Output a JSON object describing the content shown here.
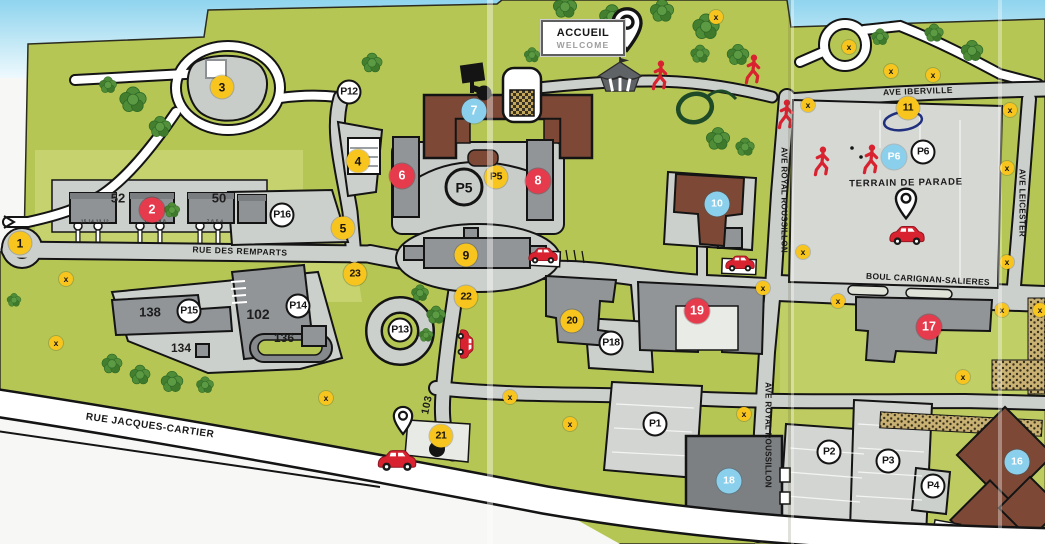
{
  "map_title": "Campus site map (scanned)",
  "sign": {
    "line1": "ACCUEIL",
    "line2": "WELCOME"
  },
  "colors": {
    "grass": "#b6c654",
    "grass_light": "#c8d472",
    "road": "#ccd0cc",
    "parade_ground": "#d6d8d4",
    "building_gray": "#919598",
    "building_brown": "#7d4936",
    "marker_yellow": "#f7c51e",
    "marker_red": "#e63b4d",
    "marker_blue": "#8ad0ec",
    "icon_red": "#d8222f",
    "sky": "#8fd4ee"
  },
  "streets": [
    {
      "id": "rue-des-remparts",
      "text": "RUE DES REMPARTS",
      "x": 240,
      "y": 251,
      "rot": 2,
      "size": 8.5,
      "sp": 0.5
    },
    {
      "id": "rue-jacques-cartier",
      "text": "RUE JACQUES-CARTIER",
      "x": 150,
      "y": 426,
      "rot": 8,
      "size": 10,
      "sp": 0.5
    },
    {
      "id": "boul-carignan-salieres",
      "text": "BOUL CARIGNAN-SALIERES",
      "x": 928,
      "y": 279,
      "rot": 3,
      "size": 8.5,
      "sp": 0.3
    },
    {
      "id": "ave-royal-roussillon-north",
      "text": "AVE ROYAL ROUSSILLON",
      "x": 784,
      "y": 200,
      "rot": 90,
      "size": 8,
      "sp": 0.3
    },
    {
      "id": "ave-royal-roussillon-south",
      "text": "AVE ROYAL ROUSSILLON",
      "x": 768,
      "y": 435,
      "rot": 90,
      "size": 8,
      "sp": 0.3
    },
    {
      "id": "ave-iberville",
      "text": "AVE IBERVILLE",
      "x": 918,
      "y": 91,
      "rot": -2,
      "size": 8.5,
      "sp": 0.5
    },
    {
      "id": "ave-leicester",
      "text": "AVE LEICESTER",
      "x": 1022,
      "y": 203,
      "rot": 90,
      "size": 8,
      "sp": 0.4
    },
    {
      "id": "terrain-de-parade",
      "text": "TERRAIN DE PARADE",
      "x": 906,
      "y": 183,
      "rot": -1,
      "size": 9.5,
      "sp": 0.8
    },
    {
      "id": "route-103",
      "text": "103",
      "x": 427,
      "y": 405,
      "rot": -78,
      "size": 10.5,
      "sp": 0.5
    }
  ],
  "building_labels": [
    {
      "text": "52",
      "x": 118,
      "y": 198,
      "size": 13
    },
    {
      "text": "50",
      "x": 219,
      "y": 198,
      "size": 13
    },
    {
      "text": "138",
      "x": 150,
      "y": 312,
      "size": 13
    },
    {
      "text": "102",
      "x": 258,
      "y": 314,
      "size": 14
    },
    {
      "text": "134",
      "x": 181,
      "y": 348,
      "size": 12
    },
    {
      "text": "136",
      "x": 284,
      "y": 338,
      "size": 12
    }
  ],
  "lot_numbers": [
    {
      "text": "15 14 13 12",
      "x": 95,
      "y": 221
    },
    {
      "text": "11 10 9 8",
      "x": 155,
      "y": 221
    },
    {
      "text": "7 6 5 4",
      "x": 215,
      "y": 221
    }
  ],
  "markers": [
    {
      "type": "yellow",
      "label": "1",
      "x": 20,
      "y": 243
    },
    {
      "type": "yellow",
      "label": "3",
      "x": 222,
      "y": 87
    },
    {
      "type": "yellow",
      "label": "4",
      "x": 358,
      "y": 161
    },
    {
      "type": "yellow",
      "label": "5",
      "x": 343,
      "y": 228
    },
    {
      "type": "yellow",
      "label": "9",
      "x": 466,
      "y": 255
    },
    {
      "type": "yellow",
      "label": "11",
      "x": 908,
      "y": 108
    },
    {
      "type": "yellow",
      "label": "20",
      "x": 572,
      "y": 321
    },
    {
      "type": "yellow",
      "label": "21",
      "x": 441,
      "y": 436
    },
    {
      "type": "yellow",
      "label": "22",
      "x": 466,
      "y": 297
    },
    {
      "type": "yellow",
      "label": "23",
      "x": 355,
      "y": 274
    },
    {
      "type": "yellow",
      "label": "P5",
      "x": 496,
      "y": 177
    },
    {
      "type": "red",
      "label": "2",
      "x": 152,
      "y": 210
    },
    {
      "type": "red",
      "label": "6",
      "x": 402,
      "y": 176
    },
    {
      "type": "red",
      "label": "8",
      "x": 538,
      "y": 181
    },
    {
      "type": "red",
      "label": "17",
      "x": 929,
      "y": 327
    },
    {
      "type": "red",
      "label": "19",
      "x": 697,
      "y": 311
    },
    {
      "type": "blue",
      "label": "7",
      "x": 474,
      "y": 111
    },
    {
      "type": "blue",
      "label": "10",
      "x": 717,
      "y": 204
    },
    {
      "type": "blue",
      "label": "16",
      "x": 1017,
      "y": 462
    },
    {
      "type": "blue",
      "label": "18",
      "x": 729,
      "y": 481
    },
    {
      "type": "blue",
      "label": "P6",
      "x": 894,
      "y": 157
    },
    {
      "type": "parking",
      "label": "P12",
      "x": 349,
      "y": 92
    },
    {
      "type": "parking",
      "label": "P16",
      "x": 282,
      "y": 215
    },
    {
      "type": "parking",
      "label": "P15",
      "x": 189,
      "y": 311
    },
    {
      "type": "parking",
      "label": "P14",
      "x": 298,
      "y": 306
    },
    {
      "type": "parking",
      "label": "P13",
      "x": 400,
      "y": 330
    },
    {
      "type": "parking",
      "label": "P18",
      "x": 611,
      "y": 343
    },
    {
      "type": "parking",
      "label": "P1",
      "x": 655,
      "y": 424
    },
    {
      "type": "parking",
      "label": "P2",
      "x": 829,
      "y": 452
    },
    {
      "type": "parking",
      "label": "P3",
      "x": 888,
      "y": 461
    },
    {
      "type": "parking",
      "label": "P4",
      "x": 933,
      "y": 486
    },
    {
      "type": "parking",
      "label": "P6",
      "x": 923,
      "y": 152
    },
    {
      "type": "ring",
      "label": "P5",
      "x": 464,
      "y": 187
    }
  ],
  "x_marks": [
    {
      "x": 716,
      "y": 17
    },
    {
      "x": 849,
      "y": 47
    },
    {
      "x": 891,
      "y": 71
    },
    {
      "x": 933,
      "y": 75
    },
    {
      "x": 808,
      "y": 105
    },
    {
      "x": 1010,
      "y": 110
    },
    {
      "x": 1007,
      "y": 168
    },
    {
      "x": 803,
      "y": 252
    },
    {
      "x": 1007,
      "y": 262
    },
    {
      "x": 763,
      "y": 288
    },
    {
      "x": 838,
      "y": 301
    },
    {
      "x": 1002,
      "y": 310
    },
    {
      "x": 1040,
      "y": 310
    },
    {
      "x": 963,
      "y": 377
    },
    {
      "x": 66,
      "y": 279
    },
    {
      "x": 56,
      "y": 343
    },
    {
      "x": 326,
      "y": 398
    },
    {
      "x": 510,
      "y": 397
    },
    {
      "x": 570,
      "y": 424
    },
    {
      "x": 744,
      "y": 414
    }
  ],
  "icons": {
    "x_glyph": "x",
    "cars": [
      {
        "x": 543,
        "y": 258,
        "rot": 0,
        "w": 34
      },
      {
        "x": 740,
        "y": 266,
        "rot": 0,
        "w": 34
      },
      {
        "x": 907,
        "y": 238,
        "rot": 0,
        "w": 40
      },
      {
        "x": 397,
        "y": 463,
        "rot": 0,
        "w": 44
      },
      {
        "x": 463,
        "y": 344,
        "rot": 90,
        "w": 34
      }
    ],
    "persons": [
      {
        "x": 660,
        "y": 78
      },
      {
        "x": 753,
        "y": 72
      },
      {
        "x": 786,
        "y": 117
      },
      {
        "x": 822,
        "y": 164
      },
      {
        "x": 871,
        "y": 162
      }
    ],
    "pins": [
      {
        "x": 627,
        "y": 32,
        "h": 46
      },
      {
        "x": 906,
        "y": 206,
        "h": 33
      },
      {
        "x": 403,
        "y": 423,
        "h": 30
      }
    ],
    "tent": {
      "x": 620,
      "y": 77,
      "w": 50
    },
    "trees": [
      {
        "x": 133,
        "y": 103,
        "s": 34
      },
      {
        "x": 160,
        "y": 130,
        "s": 28
      },
      {
        "x": 108,
        "y": 88,
        "s": 22
      },
      {
        "x": 372,
        "y": 66,
        "s": 26
      },
      {
        "x": 172,
        "y": 213,
        "s": 20
      },
      {
        "x": 14,
        "y": 303,
        "s": 18
      },
      {
        "x": 112,
        "y": 367,
        "s": 26
      },
      {
        "x": 140,
        "y": 378,
        "s": 26
      },
      {
        "x": 172,
        "y": 385,
        "s": 28
      },
      {
        "x": 205,
        "y": 388,
        "s": 22
      },
      {
        "x": 565,
        "y": 10,
        "s": 30
      },
      {
        "x": 612,
        "y": 20,
        "s": 32
      },
      {
        "x": 662,
        "y": 14,
        "s": 30
      },
      {
        "x": 706,
        "y": 30,
        "s": 34
      },
      {
        "x": 738,
        "y": 58,
        "s": 28
      },
      {
        "x": 532,
        "y": 58,
        "s": 20
      },
      {
        "x": 700,
        "y": 57,
        "s": 24
      },
      {
        "x": 718,
        "y": 142,
        "s": 30
      },
      {
        "x": 745,
        "y": 150,
        "s": 24
      },
      {
        "x": 880,
        "y": 40,
        "s": 22
      },
      {
        "x": 934,
        "y": 36,
        "s": 24
      },
      {
        "x": 972,
        "y": 54,
        "s": 28
      },
      {
        "x": 420,
        "y": 296,
        "s": 22
      },
      {
        "x": 436,
        "y": 318,
        "s": 24
      },
      {
        "x": 426,
        "y": 338,
        "s": 18
      }
    ]
  }
}
